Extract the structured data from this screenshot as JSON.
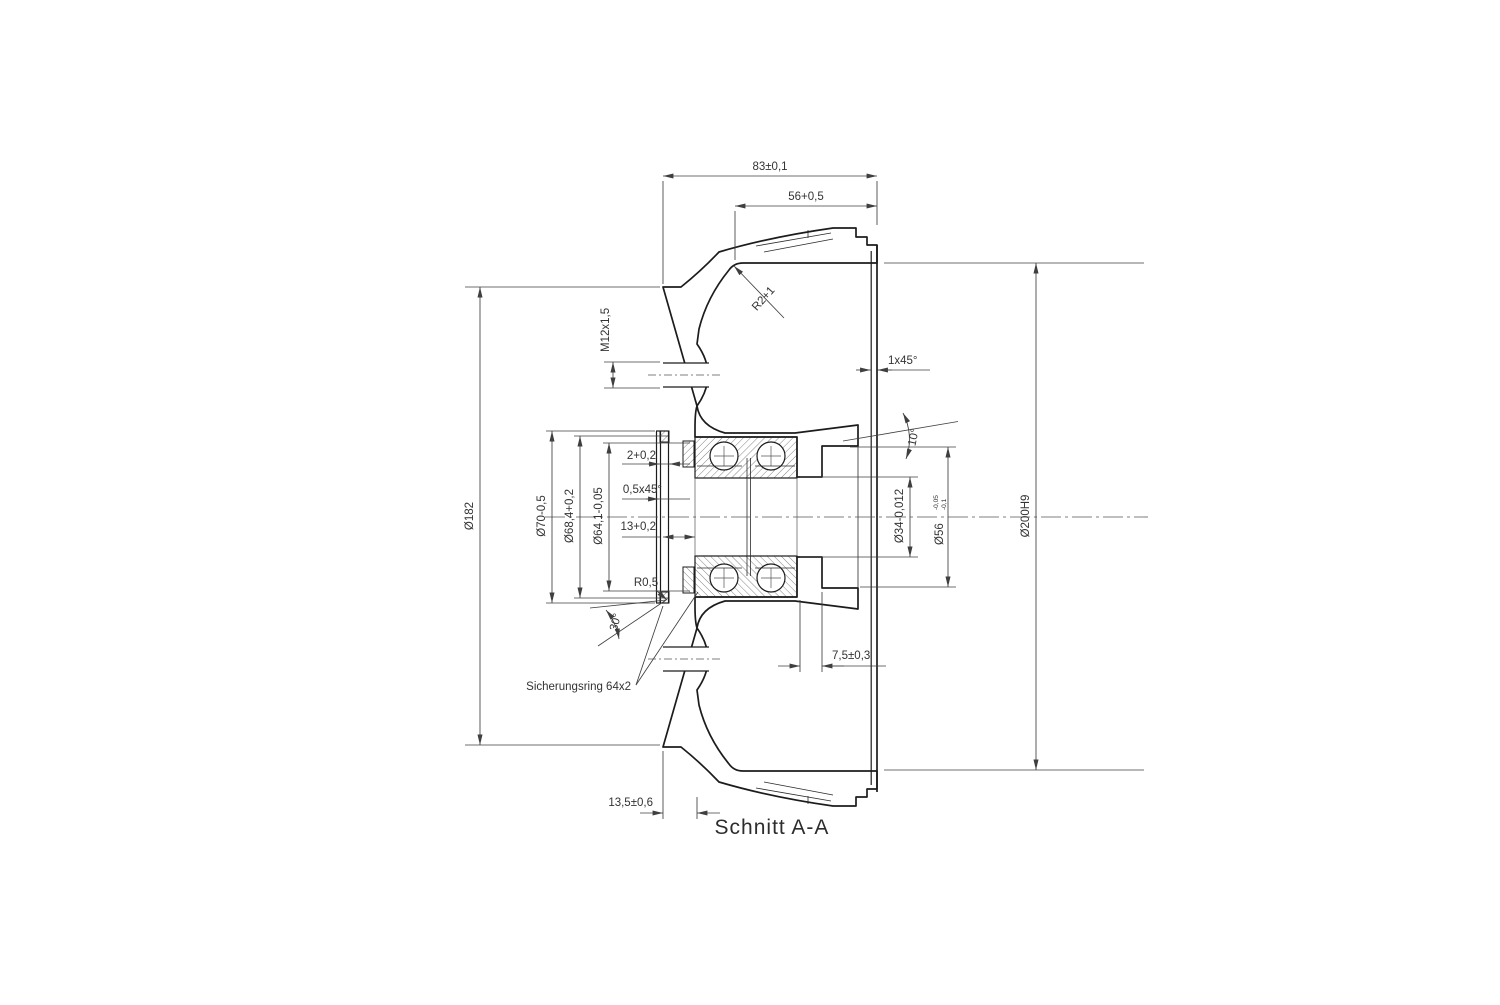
{
  "drawing": {
    "section_title": "Schnitt A-A",
    "note_circlip": "Sicherungsring 64x2",
    "dims": {
      "total_width": "83±0,1",
      "drum_depth": "56+0,5",
      "rim_fillet": "R2+1",
      "thread": "M12x1,5",
      "rim_chamfer": "1x45°",
      "face_angle": "10°",
      "groove_width": "2+0,2",
      "edge_chamfer": "0,5x45°",
      "seat_depth": "13+0,2",
      "flange_dia": "Ø182",
      "hub_dia": "Ø70-0,5",
      "groove_dia": "Ø68,4+0,2",
      "seat_dia": "Ø64,1-0,05",
      "bore_dia": "Ø34-0,012",
      "recess_dia": "Ø56",
      "recess_tol_hi": "-0,05",
      "recess_tol_lo": "-0,1",
      "drum_dia": "Ø200H9",
      "recess_depth": "7,5±0,3",
      "fillet": "R0,5",
      "chamfer_angle": "30°",
      "flange_width": "13,5±0,6"
    },
    "colors": {
      "line": "#1c1c1c",
      "dimension": "#3f3f3f",
      "background": "#ffffff"
    }
  }
}
